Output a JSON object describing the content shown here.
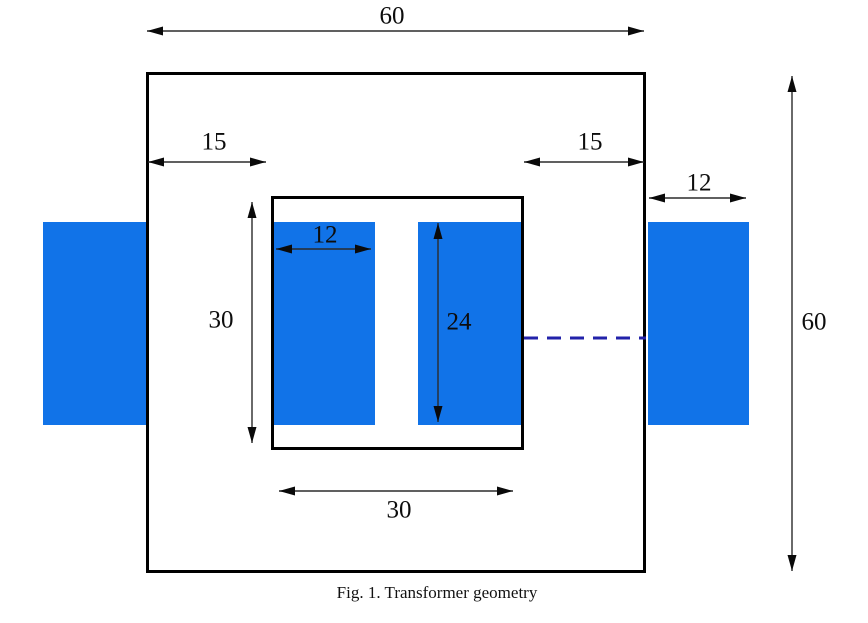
{
  "figure": {
    "caption": "Fig. 1. Transformer geometry"
  },
  "dimensions": {
    "core_width": "60",
    "core_height": "60",
    "left_limb_width": "15",
    "right_limb_width": "15",
    "outer_coil_width": "12",
    "window_coil_width": "12",
    "window_height": "30",
    "window_width": "30",
    "coil_height": "24"
  },
  "colors": {
    "coil_fill": "#1173E8",
    "dashed_line": "#2222AA",
    "core_outline": "#000000",
    "dimension_line": "#2B2B2B"
  }
}
